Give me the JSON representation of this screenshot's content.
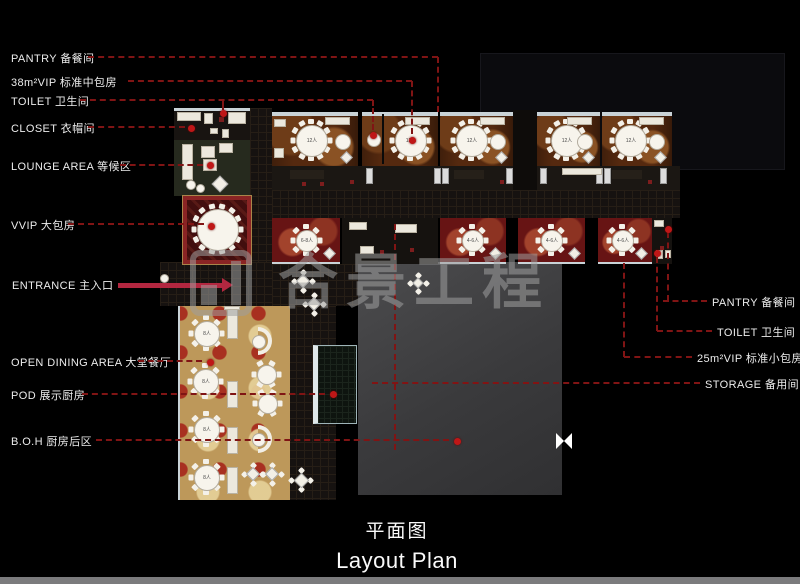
{
  "titles": {
    "cn": "平面图",
    "en": "Layout Plan"
  },
  "watermark": {
    "text": "合景工程"
  },
  "annotations": {
    "left": [
      {
        "label": "PANTRY 备餐间",
        "cy": 57,
        "segs": [
          [
            88,
            57,
            438,
            57
          ],
          [
            438,
            57,
            438,
            112
          ]
        ],
        "dots": []
      },
      {
        "label": "38m²VIP 标准中包房",
        "cy": 81,
        "segs": [
          [
            128,
            81,
            412,
            81
          ],
          [
            412,
            81,
            412,
            134
          ]
        ],
        "dots": [
          [
            412,
            140
          ]
        ]
      },
      {
        "label": "TOILET 卫生间",
        "cy": 100,
        "segs": [
          [
            80,
            100,
            373,
            100
          ],
          [
            373,
            100,
            373,
            130
          ],
          [
            223,
            100,
            223,
            110
          ]
        ],
        "dots": [
          [
            373,
            135
          ],
          [
            223,
            113
          ]
        ]
      },
      {
        "label": "CLOSET 衣帽间",
        "cy": 127,
        "segs": [
          [
            88,
            127,
            185,
            127
          ]
        ],
        "dots": [
          [
            191,
            128
          ]
        ]
      },
      {
        "label": "LOUNGE AREA 等候区",
        "cy": 165,
        "segs": [
          [
            120,
            165,
            203,
            165
          ]
        ],
        "dots": [
          [
            210,
            165
          ]
        ]
      },
      {
        "label": "VVIP 大包房",
        "cy": 224,
        "segs": [
          [
            68,
            224,
            204,
            224
          ]
        ],
        "dots": [
          [
            211,
            226
          ]
        ]
      },
      {
        "label": "OPEN DINING AREA 大堂餐厅",
        "cy": 361,
        "segs": [
          [
            138,
            361,
            202,
            361
          ]
        ],
        "dots": [
          [
            210,
            362
          ]
        ]
      },
      {
        "label": "POD 展示厨房",
        "cy": 394,
        "segs": [
          [
            82,
            394,
            325,
            394
          ]
        ],
        "dots": [
          [
            333,
            394
          ]
        ]
      },
      {
        "label": "B.O.H 厨房后区",
        "cy": 440,
        "segs": [
          [
            96,
            440,
            449,
            440
          ]
        ],
        "dots": [
          [
            457,
            441
          ]
        ]
      }
    ],
    "entrance": {
      "label": "ENTRANCE 主入口",
      "cy": 284,
      "arrow_x1": 118,
      "arrow_x2": 222,
      "arrow_y": 285
    },
    "right": [
      {
        "label": "PANTRY 备餐间",
        "tx": 712,
        "cy": 301,
        "segs": [
          [
            668,
            232,
            668,
            301
          ],
          [
            663,
            301,
            707,
            301
          ]
        ],
        "dots": [
          [
            668,
            229
          ]
        ]
      },
      {
        "label": "TOILET 卫生间",
        "tx": 717,
        "cy": 331,
        "segs": [
          [
            657,
            257,
            657,
            331
          ],
          [
            657,
            331,
            712,
            331
          ]
        ],
        "dots": [
          [
            657,
            253
          ]
        ]
      },
      {
        "label": "25m²VIP 标准小包房",
        "tx": 697,
        "cy": 357,
        "segs": [
          [
            624,
            263,
            624,
            357
          ],
          [
            624,
            357,
            692,
            357
          ]
        ],
        "dots": []
      },
      {
        "label": "STORAGE 备用间",
        "tx": 705,
        "cy": 383,
        "segs": [
          [
            372,
            383,
            700,
            383
          ]
        ],
        "dots": []
      }
    ],
    "extra_segs": [
      [
        395,
        224,
        395,
        450
      ]
    ]
  },
  "plan": {
    "rooms_top": [
      {
        "x": 272,
        "w": 86,
        "cx": 311,
        "cap": "12人"
      },
      {
        "x": 362,
        "w": 76,
        "cx": 410,
        "cap": "12人"
      },
      {
        "x": 440,
        "w": 73,
        "cx": 471,
        "cap": "12人"
      },
      {
        "x": 537,
        "w": 63,
        "cx": 566,
        "cap": "12人"
      },
      {
        "x": 602,
        "w": 70,
        "cx": 630,
        "cap": "12人"
      }
    ],
    "rooms_mid": [
      {
        "x": 272,
        "w": 68,
        "cx": 306,
        "cap": "6-8人"
      },
      {
        "x": 440,
        "w": 66,
        "cx": 472,
        "cap": "4-6人"
      },
      {
        "x": 518,
        "w": 67,
        "cx": 551,
        "cap": "4-6人"
      },
      {
        "x": 598,
        "w": 54,
        "cx": 622,
        "cap": "4-6人"
      }
    ],
    "dining_tables": [
      {
        "cx": 206,
        "cy": 333,
        "cap": "8人"
      },
      {
        "cx": 205,
        "cy": 381,
        "cap": "8人"
      },
      {
        "cx": 206,
        "cy": 429,
        "cap": "8人"
      },
      {
        "cx": 206,
        "cy": 477,
        "cap": "8人"
      }
    ],
    "colors": {
      "leader_red": "#801414",
      "dot_red": "#bf1717",
      "arrow_red": "#b32740",
      "carpet_gold": "#bd985a",
      "carpet_red": "#671414",
      "carpet_brown": "#55290f"
    }
  }
}
